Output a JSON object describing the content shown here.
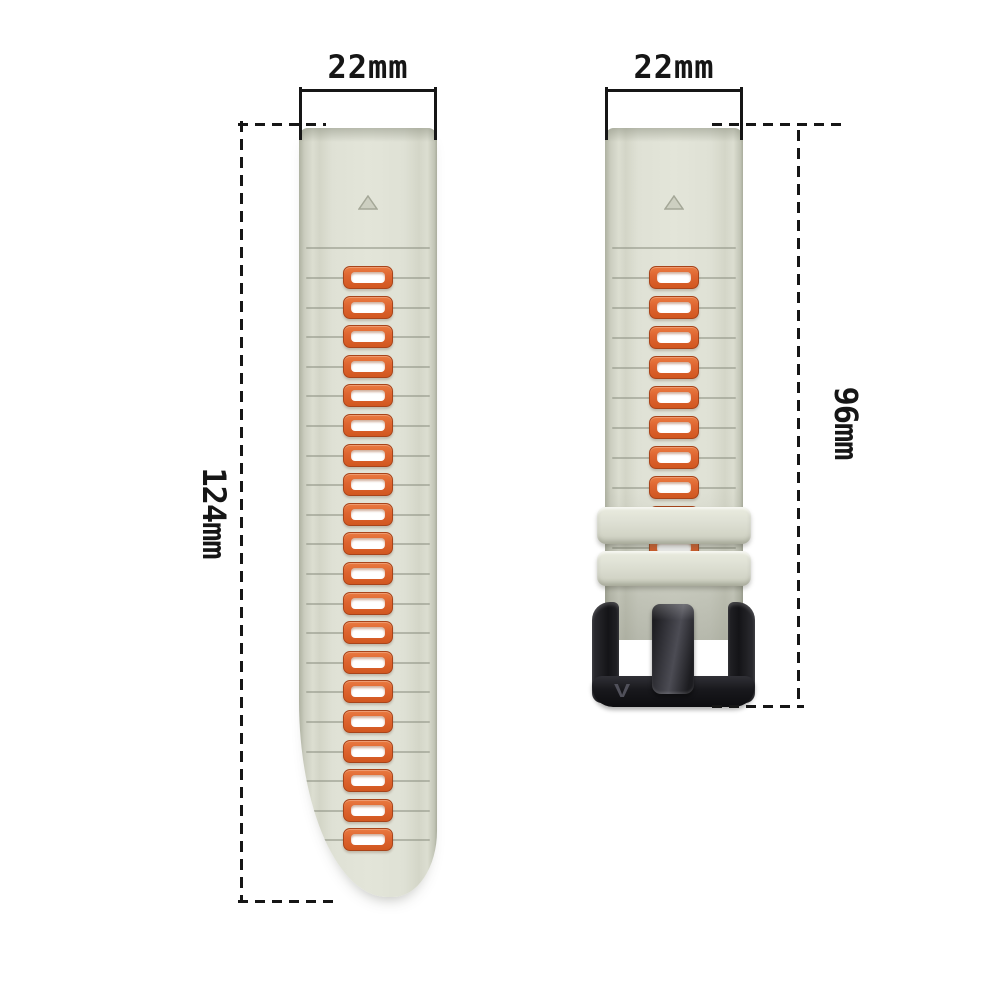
{
  "annotations": {
    "left_strap_width_label": "22mm",
    "right_strap_width_label": "22mm",
    "left_strap_length_label": "124mm",
    "right_strap_length_label": "96mm"
  },
  "left_strap": {
    "slot_count": 20,
    "marker": "triangle-up"
  },
  "right_strap": {
    "slot_count": 10,
    "keeper_count": 2,
    "buckle_engraving": "V"
  },
  "colors": {
    "background": "#ffffff",
    "strap_base": "#dfe1d5",
    "strap_edge_shadow": "#aeb1a1",
    "slot_frame_orange": "#dd6430",
    "slot_frame_border": "#a8441a",
    "slot_hole": "#ffffff",
    "groove_line": "#8e9184",
    "keeper_gray": "#dee0d4",
    "buckle_black": "#141417",
    "annotation_line": "#161616"
  }
}
